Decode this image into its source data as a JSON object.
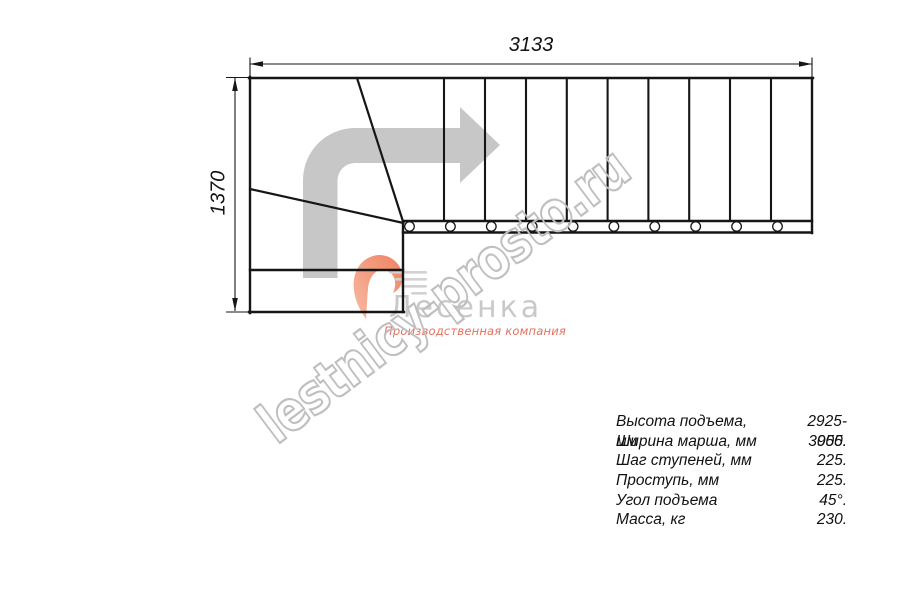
{
  "page": {
    "background": "#ffffff"
  },
  "dimensions": {
    "width_label": "3133",
    "height_label": "1370"
  },
  "drawing": {
    "type": "staircase-plan-L-turn",
    "straight_treads": 10,
    "line_color": "#161616",
    "arrow_color": "#c7c7c7"
  },
  "watermark": {
    "text": "lestnicy-prosto.ru",
    "stroke_color": "#bfbfbf"
  },
  "logo": {
    "name": "Лесенка",
    "tagline": "Производственная компания",
    "name_color": "#c9c9c9",
    "tagline_color": "#e4705e",
    "swoosh_color": "#f09a77"
  },
  "specs": {
    "rows": [
      {
        "label": "Высота подъема, мм",
        "value": "2925-3055."
      },
      {
        "label": "Ширина марша, мм",
        "value": "900."
      },
      {
        "label": "Шаг ступеней, мм",
        "value": "225."
      },
      {
        "label": "Проступь, мм",
        "value": "225."
      },
      {
        "label": "Угол подъема",
        "value": "45°."
      },
      {
        "label": "Масса, кг",
        "value": "230."
      }
    ]
  }
}
